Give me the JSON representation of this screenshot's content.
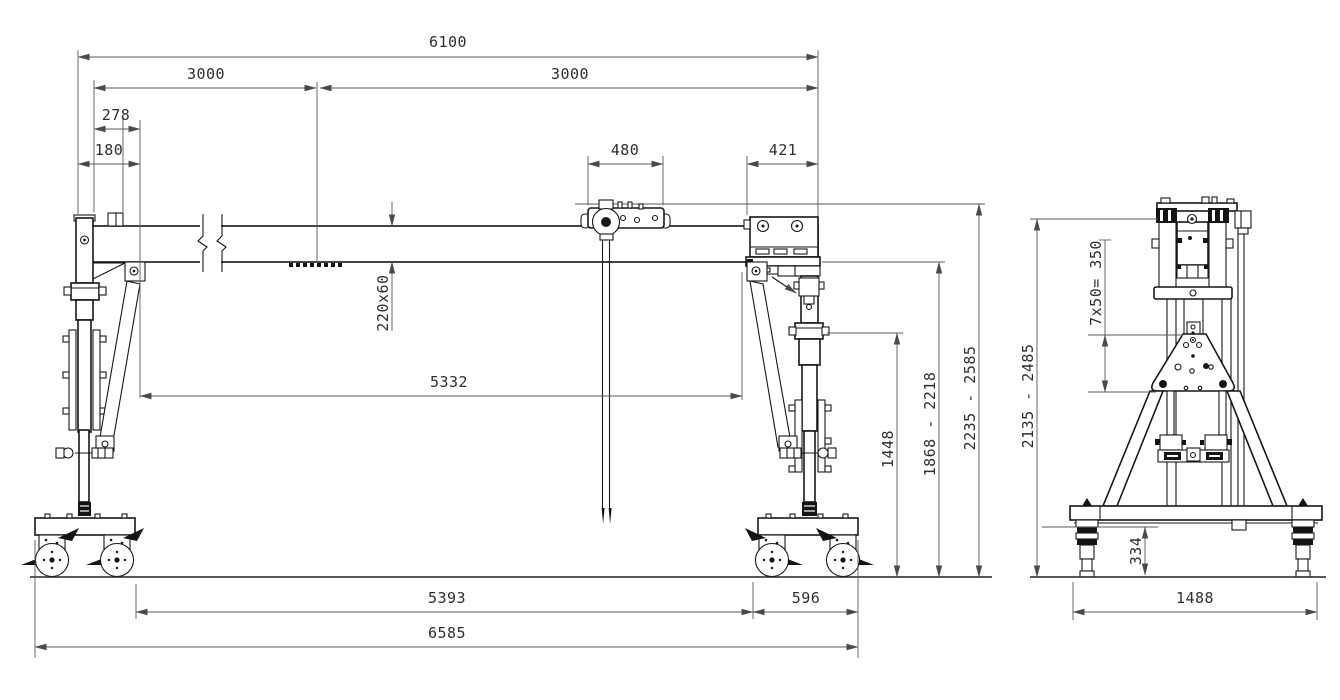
{
  "front_view": {
    "dims": {
      "overall_length": "6100",
      "rail_half_left": "3000",
      "rail_half_right": "3000",
      "end_offset_a": "278",
      "end_offset_b": "180",
      "trolley_width": "480",
      "head_width": "421",
      "girder_section": "220x60",
      "inner_span": "5332",
      "brace_height": "1448",
      "hook_height_range": "1868 - 2218",
      "overall_height_range": "2235 - 2585",
      "base_inner_span": "5393",
      "bogie_width": "596",
      "overall_base_length": "6585"
    }
  },
  "side_view": {
    "dims": {
      "height_range": "2135 - 2485",
      "hole_pitch": "7x50= 350",
      "caster_height": "334",
      "track_width": "1488"
    }
  },
  "colors": {
    "background": "#ffffff",
    "structure_line": "#171717",
    "dimension_line": "#585858",
    "dimension_text": "#2e2e2e"
  }
}
